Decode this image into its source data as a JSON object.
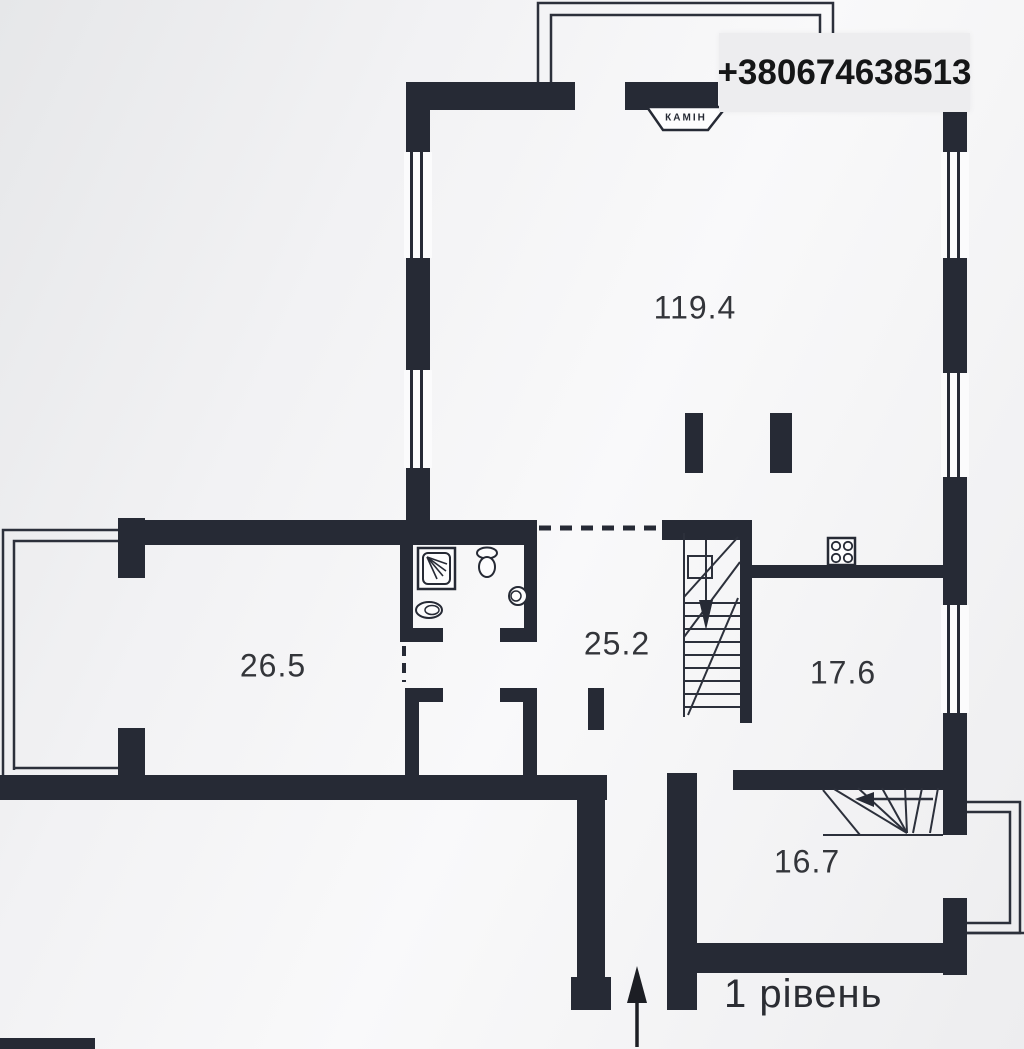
{
  "watermark": {
    "phone": "+380674638513"
  },
  "plan": {
    "level_label": "1 рівень",
    "fireplace_label": "КАМІН",
    "rooms": [
      {
        "id": "living-room",
        "area": "119.4"
      },
      {
        "id": "room-left",
        "area": "26.5"
      },
      {
        "id": "hallway",
        "area": "25.2"
      },
      {
        "id": "kitchen",
        "area": "17.6"
      },
      {
        "id": "room-bottom",
        "area": "16.7"
      }
    ],
    "symbols": {
      "fireplace": "КАМІН trapezoid on top wall",
      "stove": "4-burner square on kitchen wall",
      "shower": "square with corner spray",
      "toilet": "tank + bowl",
      "washbasin": "oval",
      "sink": "round",
      "main-stair": "straight flight with down arrow",
      "winder-stair": "corner fan with left arrow",
      "entrance": "up arrow at bottom"
    },
    "icons": {
      "entrance-arrow": "↑",
      "stair-down-arrow": "▼",
      "stair-up-arrow": "←"
    }
  },
  "colors": {
    "wall": "#262a35",
    "line": "#2c303b",
    "background": "#f2f2f4",
    "banner_bg": "#ededef",
    "text": "#33353a"
  }
}
